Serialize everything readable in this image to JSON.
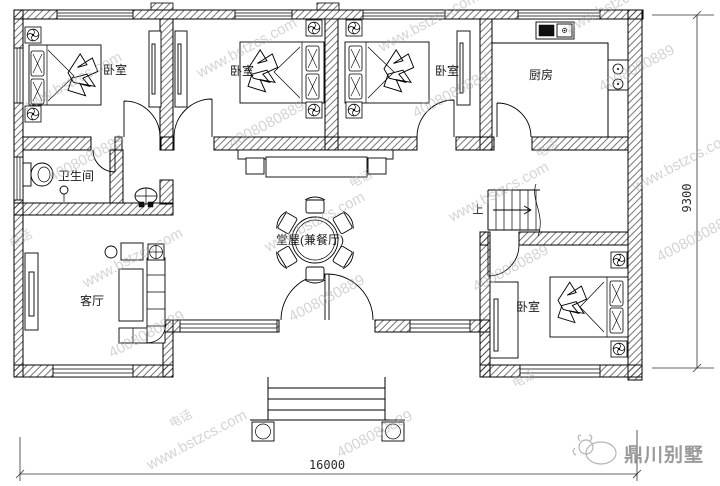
{
  "plan": {
    "rooms": {
      "bedroom1": "卧室",
      "bedroom2": "卧室",
      "bedroom3": "卧室",
      "bedroom4": "卧室",
      "kitchen": "厨房",
      "bathroom": "卫生间",
      "hall": "堂屋(兼餐厅)",
      "living_room": "客厅",
      "stairs_up": "上"
    },
    "dimensions": {
      "total_width": "16000",
      "total_depth": "9300"
    },
    "watermark": {
      "site": "www.bstzcs.com",
      "phone": "4008080889",
      "tel": "电话"
    },
    "logo": {
      "brand": "鼎川别墅"
    }
  }
}
